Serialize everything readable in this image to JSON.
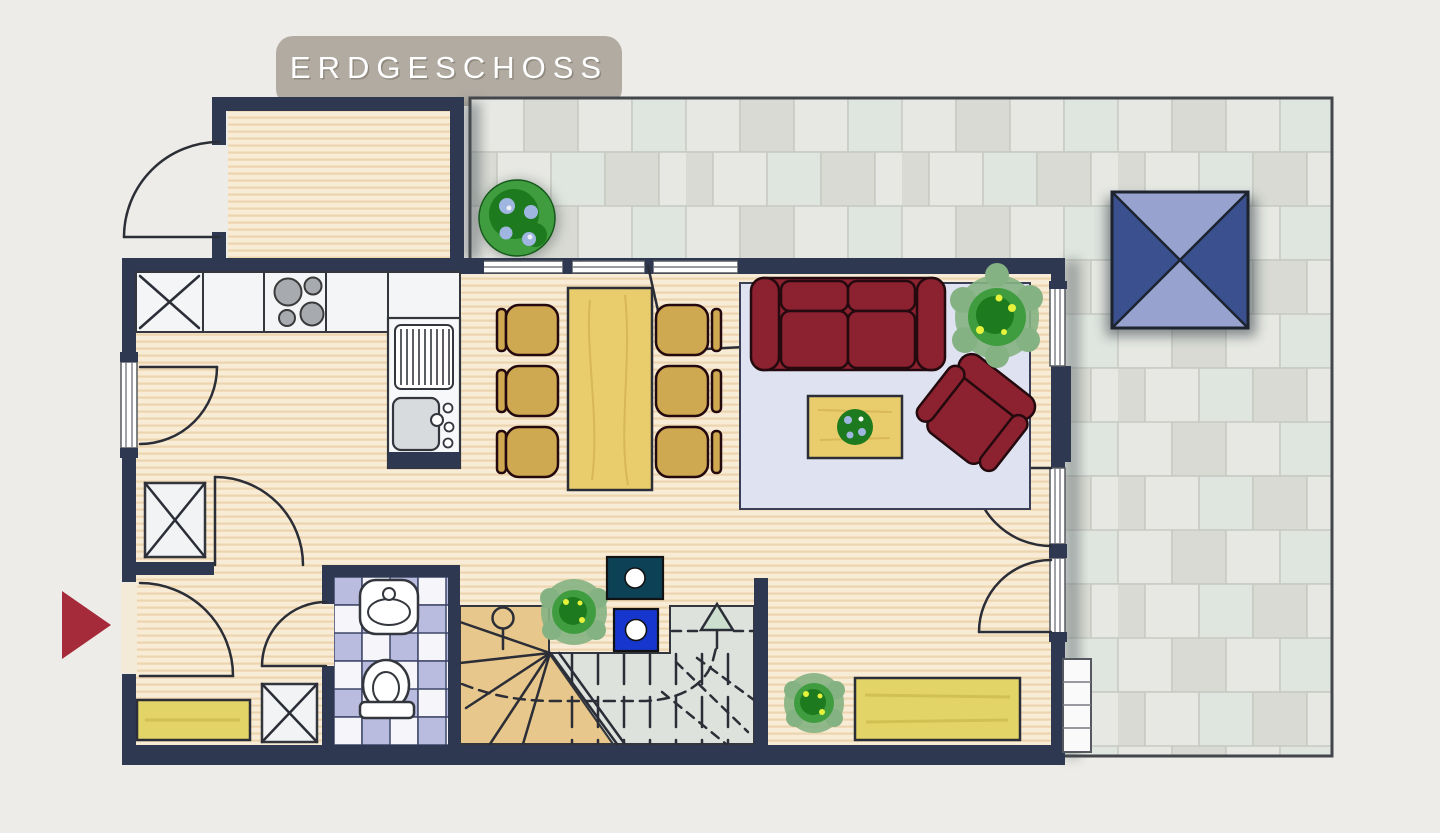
{
  "title": {
    "label": "ERDGESCHOSS"
  },
  "colors": {
    "page_bg": "#edece8",
    "tab_bg": "#b1aba2",
    "tab_text": "#ffffff",
    "wall": "#2e3951",
    "floor_light": "#f8ecd7",
    "floor_stripe": "#ecd5ae",
    "counter": "#f4f5f7",
    "tile_a": "#e7e8e3",
    "tile_b": "#d8dad3",
    "tile_c": "#dfe5df",
    "bath_tile": "#b9bcdf",
    "stair_tan": "#e8c78c",
    "stair_gray": "#dde2dd",
    "rug": "#dfe2f0",
    "sofa": "#8c2130",
    "chair": "#cfa852",
    "table_wood": "#e9cd6c",
    "bench": "#e3d468",
    "plant_dark": "#1e7a1e",
    "plant_mid": "#3f9c3f",
    "plant_light": "#85b283",
    "flower_blue": "#9fb6e0",
    "parasol_dark": "#3b508e",
    "parasol_light": "#98a2cf",
    "marker_teal": "#0c4156",
    "marker_blue": "#1736cd",
    "arrow_red": "#a52a3a"
  },
  "icons": {
    "entrance_arrow": "right-triangle",
    "stair_direction_arrow": "up-triangle",
    "stair_markers": [
      "dark-dot-square",
      "blue-dot-square"
    ]
  }
}
